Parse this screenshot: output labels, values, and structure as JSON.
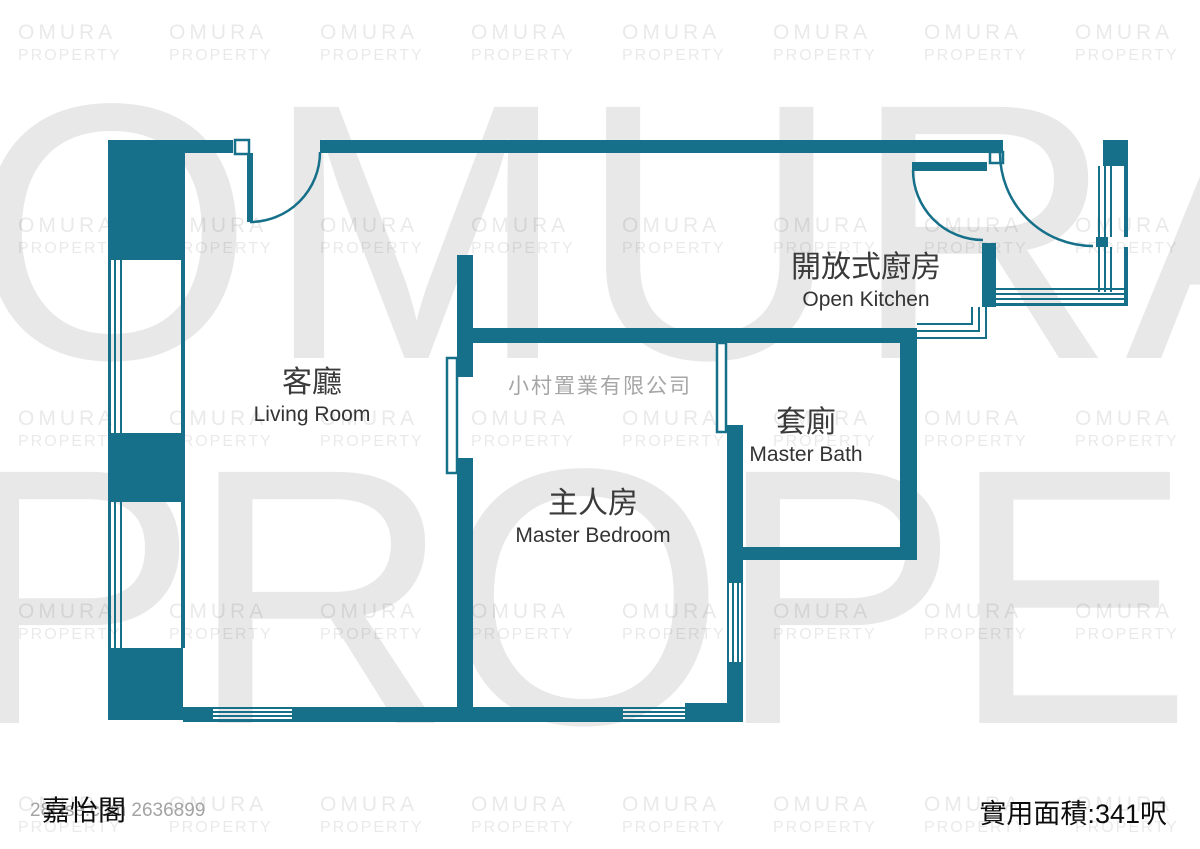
{
  "watermark": {
    "brand_line1": "OMURA",
    "brand_line2": "PROPERTY",
    "center_company": "小村置業有限公司"
  },
  "rooms": [
    {
      "id": "living-room",
      "zh": "客廳",
      "en": "Living Room"
    },
    {
      "id": "master-bedroom",
      "zh": "主人房",
      "en": "Master Bedroom"
    },
    {
      "id": "master-bath",
      "zh": "套廁",
      "en": "Master Bath"
    },
    {
      "id": "open-kitchen",
      "zh": "開放式廚房",
      "en": "Open Kitchen"
    }
  ],
  "footer": {
    "building_name": "嘉怡閣",
    "listing_ref": "28Hse.com 2636899",
    "area_label": "實用面積:341呎"
  },
  "colors": {
    "wall_teal": "#16708a",
    "watermark_gray": "#e8e8e8",
    "text_dark": "#0d0d0d",
    "company_gray": "#a6a6a6"
  }
}
